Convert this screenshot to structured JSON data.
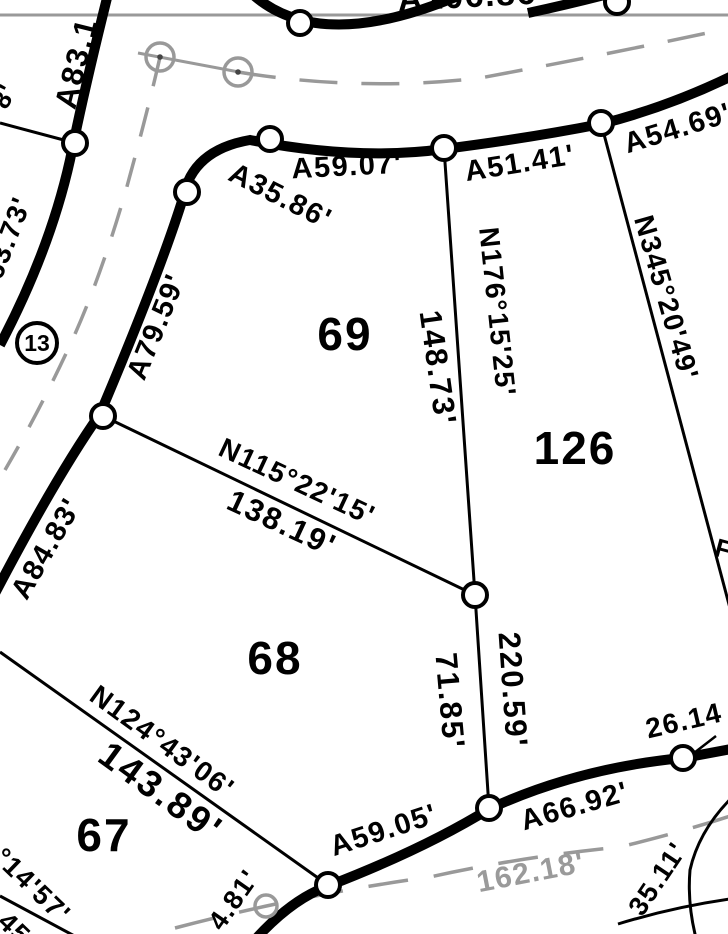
{
  "map_type": "plat-survey-map",
  "lots": {
    "lot69": "69",
    "lot126": "126",
    "lot68": "68",
    "lot67": "67"
  },
  "monument": {
    "label": "13"
  },
  "arc_labels": {
    "a106_86": "A106.86'",
    "a83_1": "A83.1",
    "a59_07": "A59.07'",
    "a51_41": "A51.41'",
    "a54_69": "A54.69'",
    "a35_86": "A35.86'",
    "a79_59": "A79.59'",
    "a84_83": "A84.83'",
    "a59_05": "A59.05'",
    "a66_92": "A66.92'"
  },
  "bearing_labels": {
    "n345": "N345°20'49'",
    "n176": "N176°15'25'",
    "n115": "N115°22'15'",
    "n124": "N124°43'06'"
  },
  "distance_labels": {
    "d148_73": "148.73'",
    "d220_59": "220.59'",
    "d71_85": "71.85'",
    "d138_19": "138.19'",
    "d143_89": "143.89'",
    "d63_73": "63.73'",
    "d26_14": "26.14",
    "d162_18": "162.18'",
    "d35_11": "35.11'",
    "d4_81": "4.81'"
  },
  "partial_labels": {
    "left_edge_8": "8'",
    "bottom_left_bearing": "°14'57'",
    "bottom_left_distance": "45",
    "right_edge_glyph": "F"
  },
  "colors": {
    "line_black": "#000000",
    "centerline_gray": "#999999",
    "gray_text": "#9a9a9a"
  }
}
